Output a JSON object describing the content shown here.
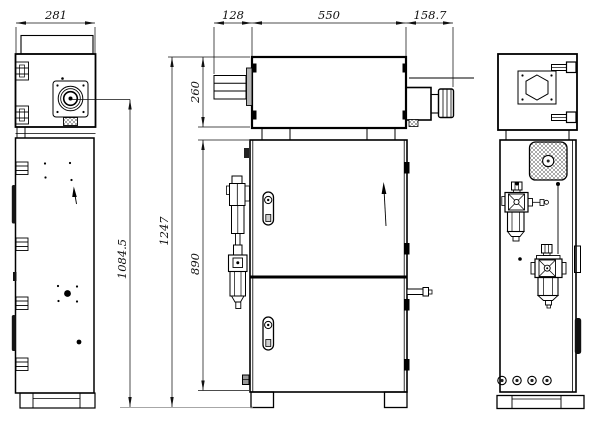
{
  "drawing": {
    "dimensions": {
      "depth": "281",
      "head_offset": "128",
      "head_length": "550",
      "nozzle_extension": "158.7",
      "head_height": "260",
      "total_height": "1247",
      "cabinet_height": "890",
      "emission_height": "1084.5"
    },
    "colors": {
      "line": "#000000",
      "background": "#ffffff",
      "flange_fill": "#b5b5b5",
      "dark_fill": "#151515"
    }
  }
}
